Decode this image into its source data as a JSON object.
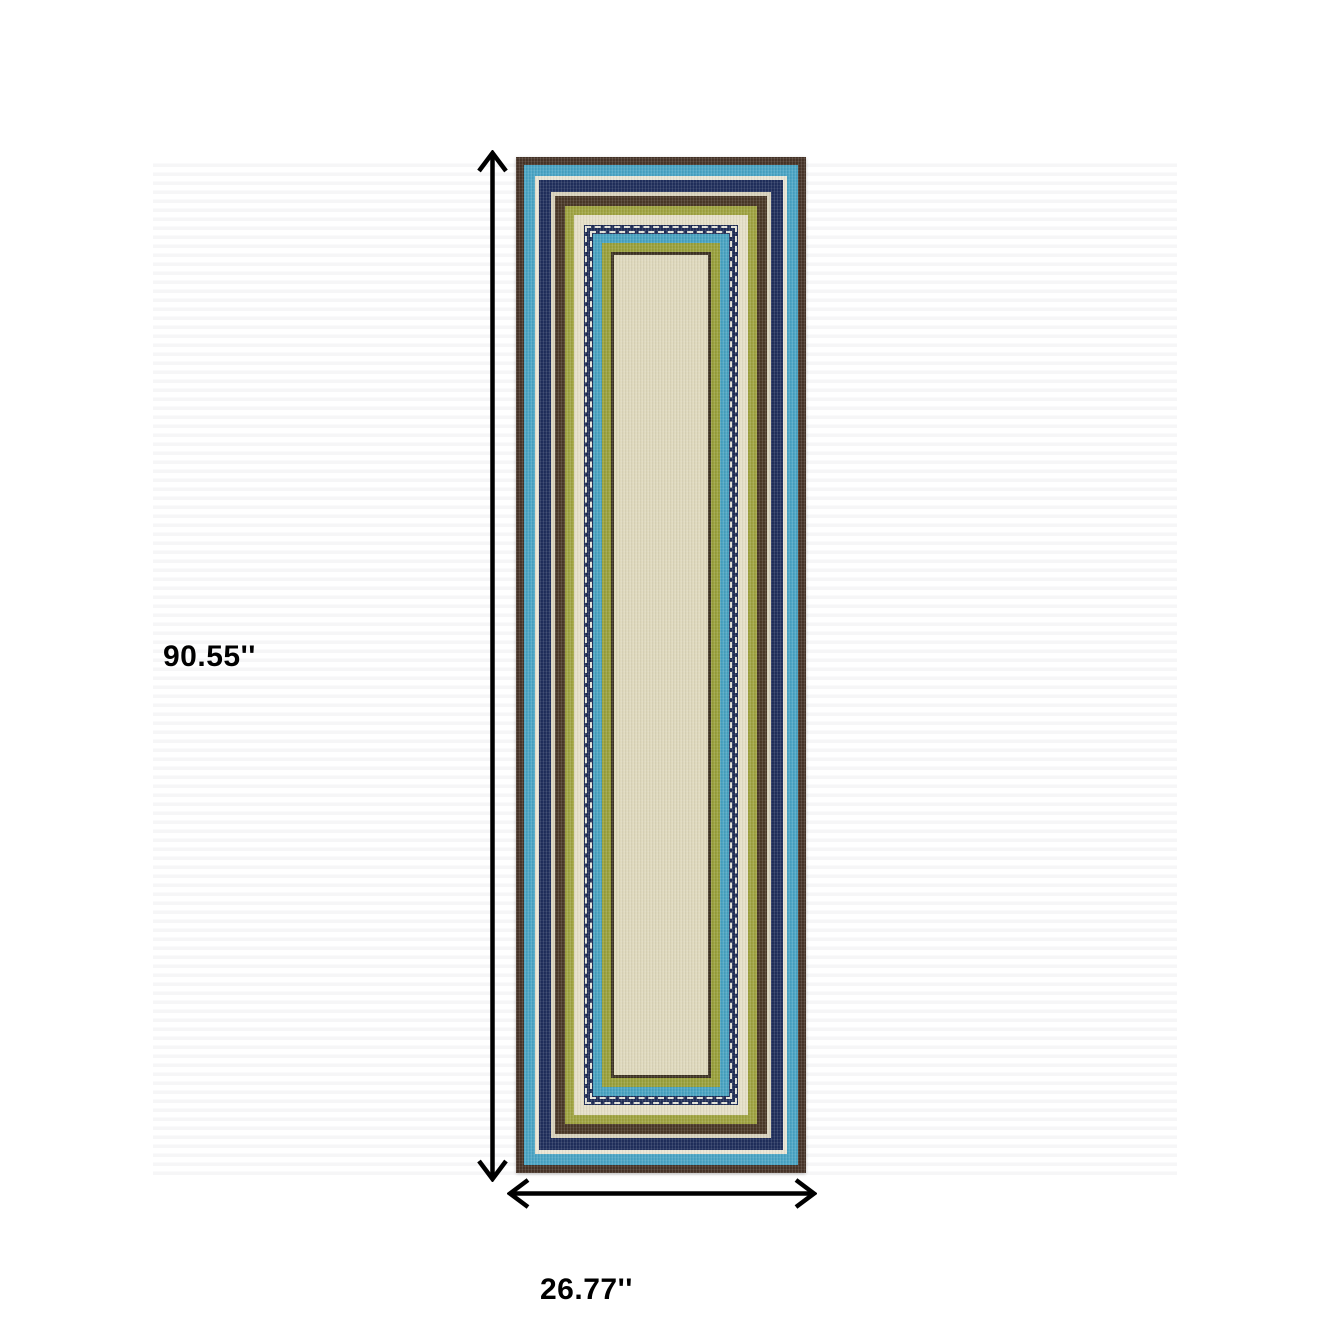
{
  "diagram": {
    "type": "product-dimension-diagram",
    "product": "striped runner rug",
    "background_color": "#ffffff",
    "arrow_color": "#000000",
    "height_label": "90.55''",
    "width_label": "26.77''"
  },
  "rug": {
    "field_color": "#ded8bc",
    "stripes": [
      {
        "name": "outer-brown-border",
        "color": "#473428",
        "width": 8
      },
      {
        "name": "sky-blue-stripe",
        "color": "#4aa4c4",
        "width": 11
      },
      {
        "name": "ivory-stripe",
        "color": "#e9e5d4",
        "width": 4
      },
      {
        "name": "navy-stripe",
        "color": "#202f5c",
        "width": 12
      },
      {
        "name": "ivory-thin-stripe",
        "color": "#d8d2bc",
        "width": 4
      },
      {
        "name": "brown-stripe",
        "color": "#4a3827",
        "width": 10
      },
      {
        "name": "olive-stripe",
        "color": "#9fa340",
        "width": 9
      },
      {
        "name": "ivory-stripe-inner",
        "color": "#e5dfc7",
        "width": 10
      },
      {
        "name": "navy-dotted-stripe",
        "color": "#1f2c55",
        "width": 9,
        "dotted": true
      },
      {
        "name": "sky-blue-stripe-inner",
        "color": "#49a3c1",
        "width": 9
      },
      {
        "name": "olive-stripe-inner",
        "color": "#99a03b",
        "width": 9
      },
      {
        "name": "dark-brown-line",
        "color": "#3d3222",
        "width": 3
      }
    ]
  }
}
